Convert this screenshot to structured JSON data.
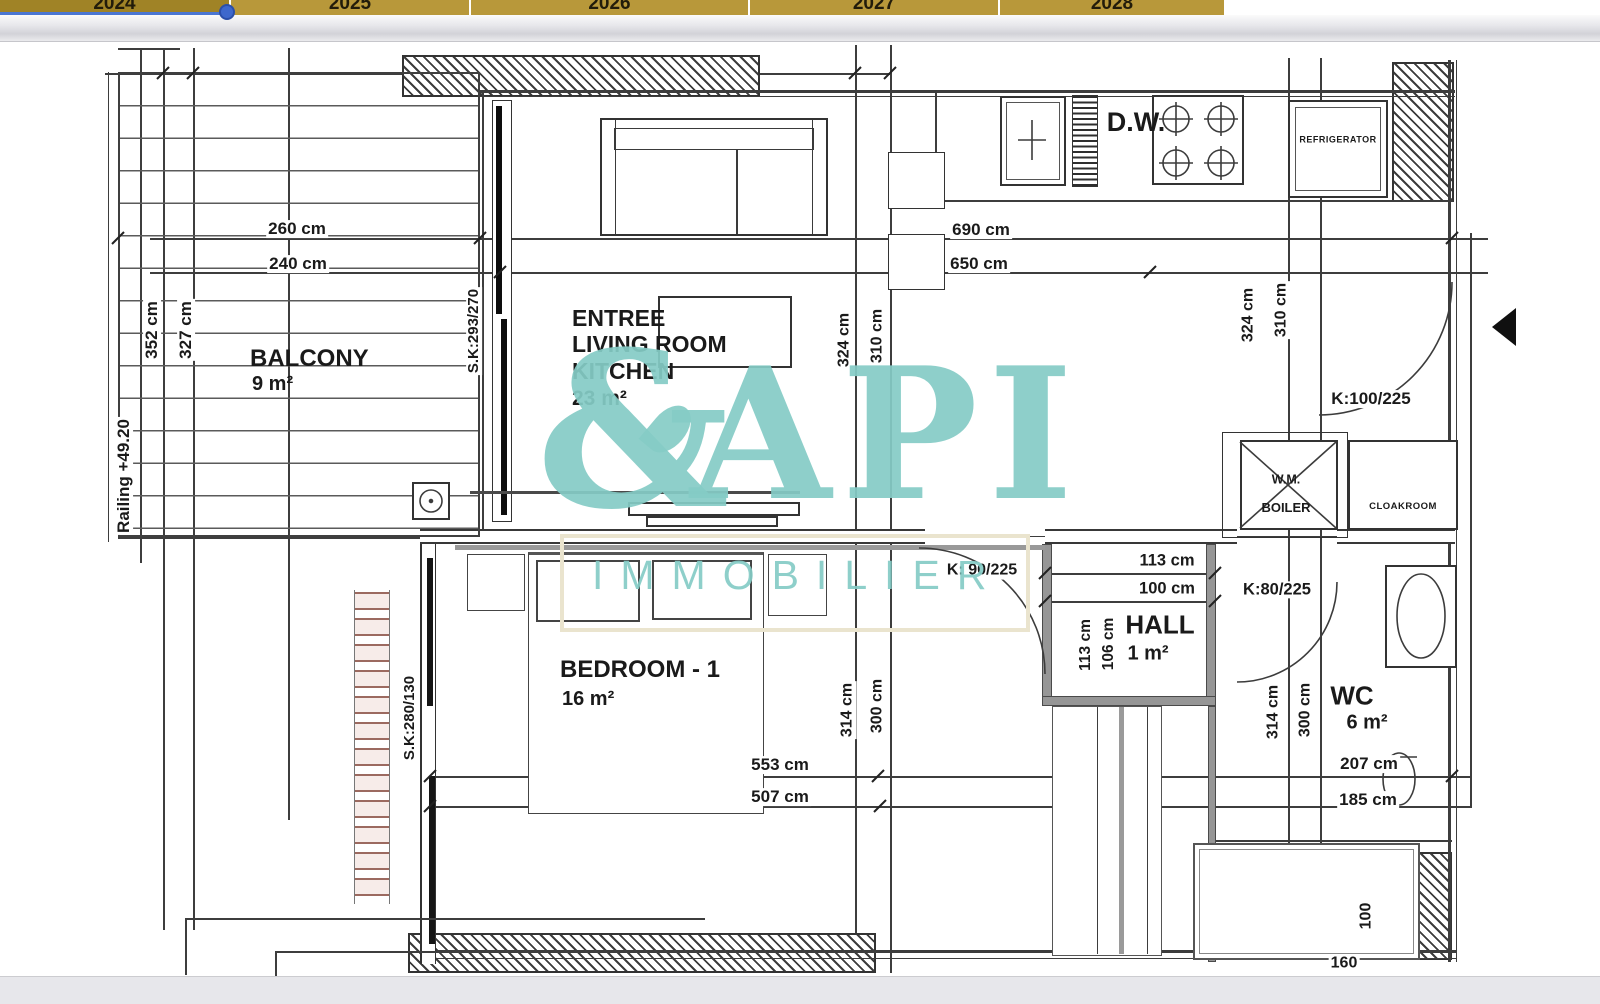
{
  "timeline": {
    "years": [
      "2024",
      "2025",
      "2026",
      "2027",
      "2028"
    ],
    "selected_year": "2024"
  },
  "watermark": {
    "logo_amp": "&",
    "logo_rest": "API",
    "subtitle": "IMMOBILIER",
    "color": "#85ccc6"
  },
  "plan": {
    "rooms": {
      "balcony": {
        "name": "BALCONY",
        "area": "9 m²"
      },
      "living": {
        "name_line1": "ENTREE",
        "name_line2": "LIVING ROOM",
        "name_line3": "KITCHEN",
        "area": "23 m²"
      },
      "bedroom": {
        "name": "BEDROOM - 1",
        "area": "16 m²"
      },
      "hall": {
        "name": "HALL",
        "area": "1 m²"
      },
      "wc": {
        "name": "WC",
        "area": "6 m²"
      }
    },
    "fixtures": {
      "dishwasher": "D.W.",
      "refrigerator": "REFRIGERATOR",
      "washing_machine": "W.M.",
      "boiler": "BOILER",
      "cloakroom": "CLOAKROOM"
    },
    "openings": {
      "entry_door": "K:100/225",
      "living_hall_door": "K: 90/225",
      "wc_door": "K:80/225",
      "balcony_sliding_door": "S.K:293/270",
      "bedroom_window": "S.K:280/130",
      "railing_level": "Railing +49.20"
    },
    "dimensions": {
      "balcony_width_outer": "260 cm",
      "balcony_width_inner": "240 cm",
      "balcony_depth_outer": "352 cm",
      "balcony_depth_inner": "327 cm",
      "kitchen_width_outer": "690 cm",
      "kitchen_width_inner": "650 cm",
      "living_depth_outer_left": "324 cm",
      "living_depth_inner_left": "310 cm",
      "living_depth_outer_right": "324 cm",
      "living_depth_inner_right": "310 cm",
      "bedroom_width_outer": "553 cm",
      "bedroom_width_inner": "507 cm",
      "bedroom_depth_outer": "314 cm",
      "bedroom_depth_inner": "300 cm",
      "hall_width_outer": "113 cm",
      "hall_width_inner": "100 cm",
      "hall_depth_outer": "113 cm",
      "hall_depth_inner": "106 cm",
      "wc_depth_outer": "314 cm",
      "wc_depth_inner": "300 cm",
      "wc_width_outer": "207 cm",
      "wc_width_inner": "185 cm",
      "shower_depth": "100",
      "shower_width": "160"
    }
  }
}
